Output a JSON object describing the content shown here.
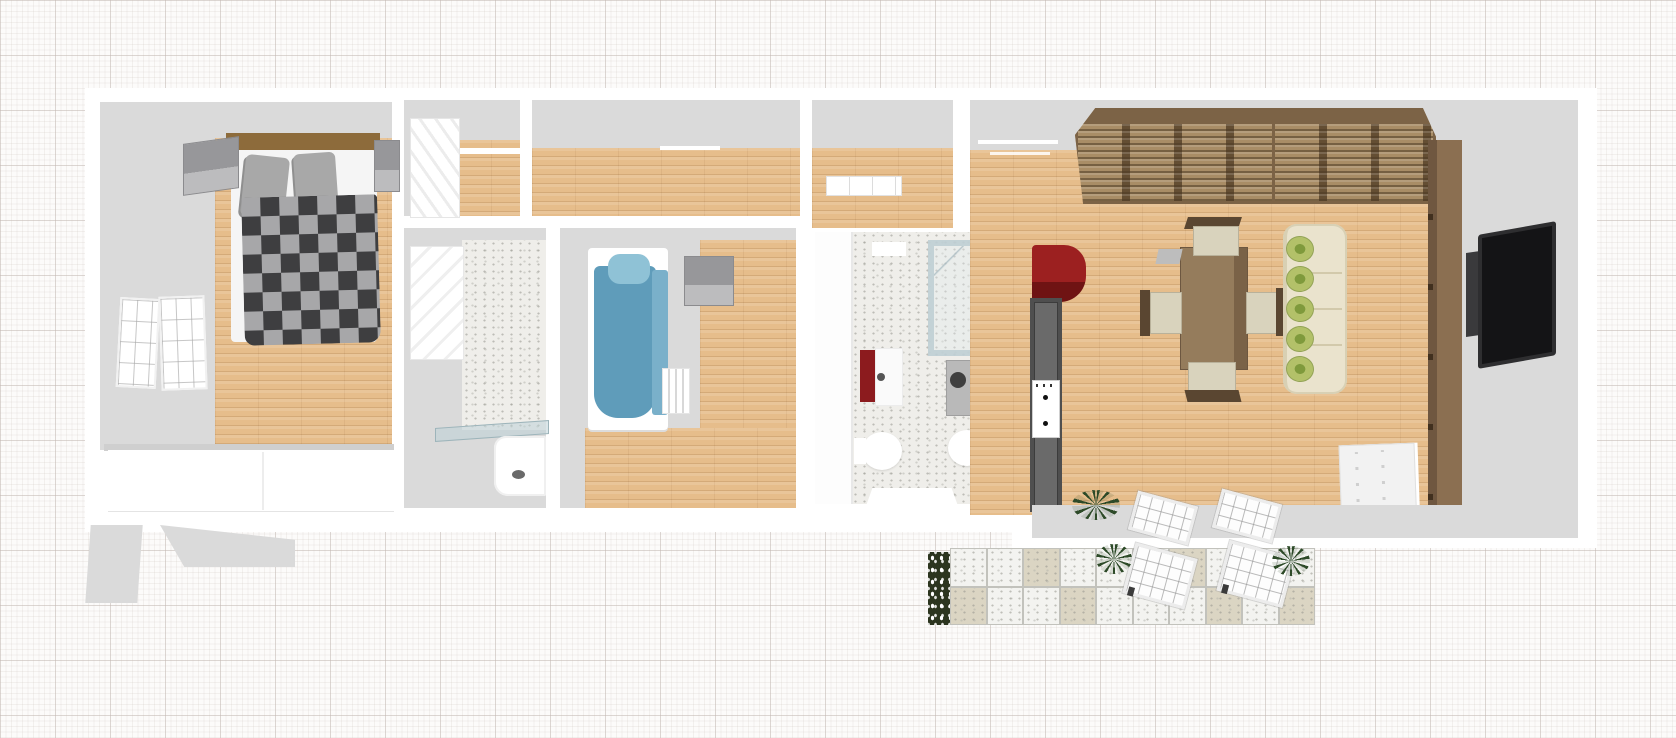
{
  "scene": {
    "type": "3d-floor-plan-top-view",
    "background": "graph-paper-grid",
    "ui_text": "none"
  },
  "colors": {
    "wall-face": "#dadada",
    "wood": "#e6bd8b",
    "terrazzo": "#efeeea",
    "checker-dark": "#3e3e40",
    "checker-light": "#a7a7a9",
    "bed-blue": "#5f9cba",
    "bed-blue-light": "#8fc2d6",
    "maroon": "#8c1b1e",
    "kitchen-red": "#8e1b1b",
    "counter-dark": "#4f4f4f",
    "table-brown": "#8b7254",
    "chair-cream": "#d9d3bd",
    "chair-frame": "#5a4631",
    "sofa-cream": "#eae3cd",
    "pillow-green": "#b3c169",
    "tv-unit": "#8b6f51",
    "tv-unit-dark": "#6f5740",
    "tv-black": "#141416",
    "tile-white": "#f3f3f0",
    "tile-beige": "#dbd5c3",
    "plant": "#2d4a28",
    "flower-bed": "#2c351f"
  },
  "rooms": [
    {
      "name": "master-bedroom",
      "floor": "wood+gray",
      "furniture": [
        "double-bed-checkered-duvet",
        "gray-pillows-x2",
        "nightstand-left",
        "nightstand-right",
        "white-wardrobe",
        "folding-window-screen"
      ]
    },
    {
      "name": "closet-room",
      "floor": "gray+wood",
      "furniture": [
        "white-dresser",
        "wall-shelf"
      ]
    },
    {
      "name": "shower-room",
      "floor": "terrazzo",
      "furniture": [
        "white-cabinet",
        "glass-screen",
        "shower-tray"
      ]
    },
    {
      "name": "hallway",
      "floor": "wood"
    },
    {
      "name": "entry",
      "floor": "wood",
      "furniture": [
        "open-door-leaf"
      ]
    },
    {
      "name": "kids-bedroom",
      "floor": "wood+gray",
      "furniture": [
        "single-bed-blue",
        "blue-pillow",
        "gray-cube-nightstand",
        "radiator"
      ]
    },
    {
      "name": "bathroom",
      "floor": "terrazzo",
      "furniture": [
        "glass-shower-enclosure",
        "sink-maroon-cabinet",
        "washing-machine",
        "toilet",
        "bidet",
        "open-door-white"
      ]
    },
    {
      "name": "living-kitchen",
      "floor": "wood",
      "furniture": [
        "pergola-slats-a",
        "pergola-slats-b",
        "red-kitchen-cabinet",
        "dark-kitchen-counter",
        "cooktop",
        "dining-table",
        "chairs-x4",
        "cream-sofa",
        "green-pillows-x5",
        "tv-wall-unit",
        "wall-tv",
        "shoe-cabinet",
        "french-door-panels-x2"
      ]
    }
  ],
  "sofa": {
    "pillow_count": 5
  },
  "patio": {
    "tile_cols": 10,
    "tile_rows": 2,
    "pattern": [
      [
        "w",
        "w",
        "b",
        "w",
        "w",
        "w",
        "b",
        "w",
        "w",
        "w"
      ],
      [
        "b",
        "w",
        "w",
        "b",
        "w",
        "w",
        "w",
        "b",
        "w",
        "b"
      ]
    ],
    "items": [
      "flower-border",
      "palm-plant-x3",
      "sun-lounger-x2"
    ]
  }
}
